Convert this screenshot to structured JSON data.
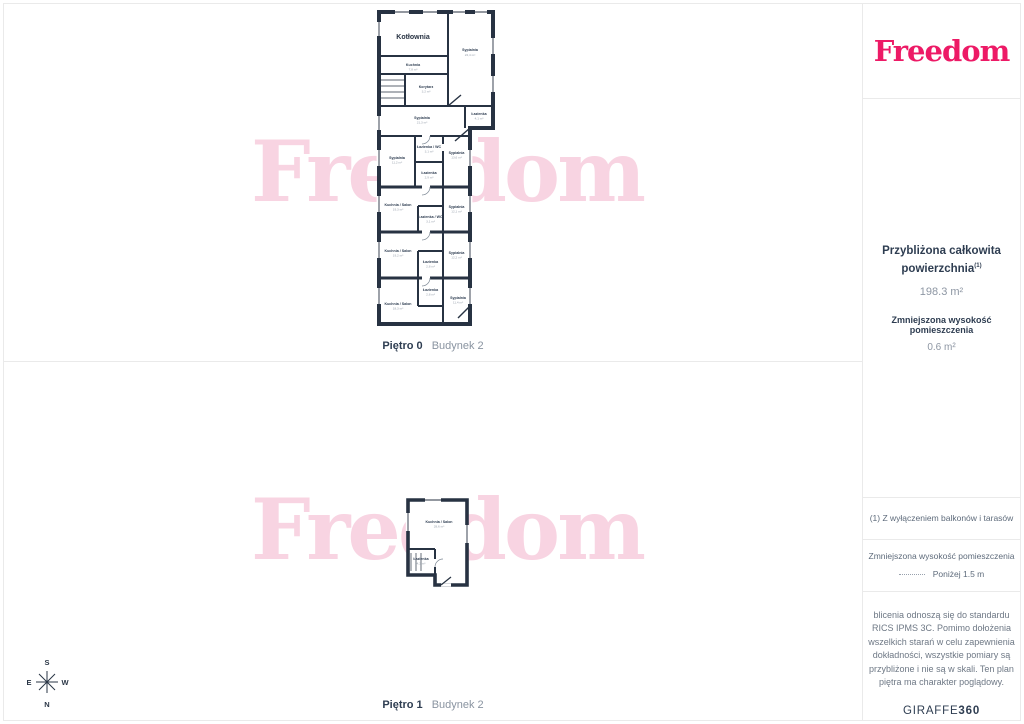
{
  "sidebar": {
    "logo": "Freedom",
    "summary": {
      "title_line1": "Przybliżona całkowita",
      "title_line2": "powierzchnia",
      "title_sup": "(1)",
      "total_area": "198.3 m²",
      "reduced_title": "Zmniejszona wysokość pomieszczenia",
      "reduced_area": "0.6 m²"
    },
    "footnote": "(1) Z wyłączeniem balkonów i tarasów",
    "legend": {
      "title": "Zmniejszona wysokość pomieszczenia",
      "item": "Poniżej 1.5 m"
    },
    "disclaimer": {
      "lines": [
        "blicenia odnoszą się do standardu",
        "RICS IPMS 3C. Pomimo dołożenia",
        "wszelkich starań w celu zapewnienia",
        "dokładności, wszystkie pomiary są",
        "przybliżone i nie są w skali. Ten plan",
        "piętra ma charakter poglądowy."
      ],
      "brand_main": "GIRAFFE",
      "brand_suffix": "360"
    }
  },
  "panels": {
    "floor0": {
      "label_bold": "Piętro 0",
      "label_light": "Budynek 2",
      "watermark": "Freedom",
      "rooms": [
        {
          "name": "Kotłownia",
          "area": ""
        },
        {
          "name": "Sypialnia",
          "area": "22,4 m²"
        },
        {
          "name": "Kuchnia",
          "area": "7,8 m²"
        },
        {
          "name": "Korytarz",
          "area": "3,2 m²"
        },
        {
          "name": "Sypialnia",
          "area": "21,3 m²"
        },
        {
          "name": "Łazienka",
          "area": "4,1 m²"
        },
        {
          "name": "Łazienka / WC",
          "area": "3,1 m²"
        },
        {
          "name": "Sypialnia",
          "area": "13,6 m²"
        },
        {
          "name": "Sypialnia",
          "area": "11,2 m²"
        },
        {
          "name": "Łazienka",
          "area": "2,9 m²"
        },
        {
          "name": "Kuchnia / Salon",
          "area": "19,3 m²"
        },
        {
          "name": "Sypialnia",
          "area": "12,1 m²"
        },
        {
          "name": "Łazienka / WC",
          "area": "3,1 m²"
        },
        {
          "name": "Kuchnia / Salon",
          "area": "19,2 m²"
        },
        {
          "name": "Sypialnia",
          "area": "12,2 m²"
        },
        {
          "name": "Łazienka",
          "area": "2,8 m²"
        },
        {
          "name": "Łazienka",
          "area": "2,8 m²"
        },
        {
          "name": "Kuchnia / Salon",
          "area": "18,3 m²"
        },
        {
          "name": "Sypialnia",
          "area": "11,4 m²"
        }
      ]
    },
    "floor1": {
      "label_bold": "Piętro 1",
      "label_light": "Budynek 2",
      "watermark": "Freedom",
      "rooms": [
        {
          "name": "Kuchnia / Salon",
          "area": "28,6 m²"
        },
        {
          "name": "Łazienka",
          "area": "4,2 m²"
        }
      ]
    }
  },
  "compass": {
    "n": "N",
    "s": "S",
    "e": "E",
    "w": "W"
  },
  "colors": {
    "brand_pink": "#ed1a66",
    "watermark_pink": "#f8d4e2",
    "wall_navy": "#273242",
    "text_navy": "#2e3d51",
    "text_gray": "#8d96a3",
    "border_gray": "#eaeaea"
  }
}
